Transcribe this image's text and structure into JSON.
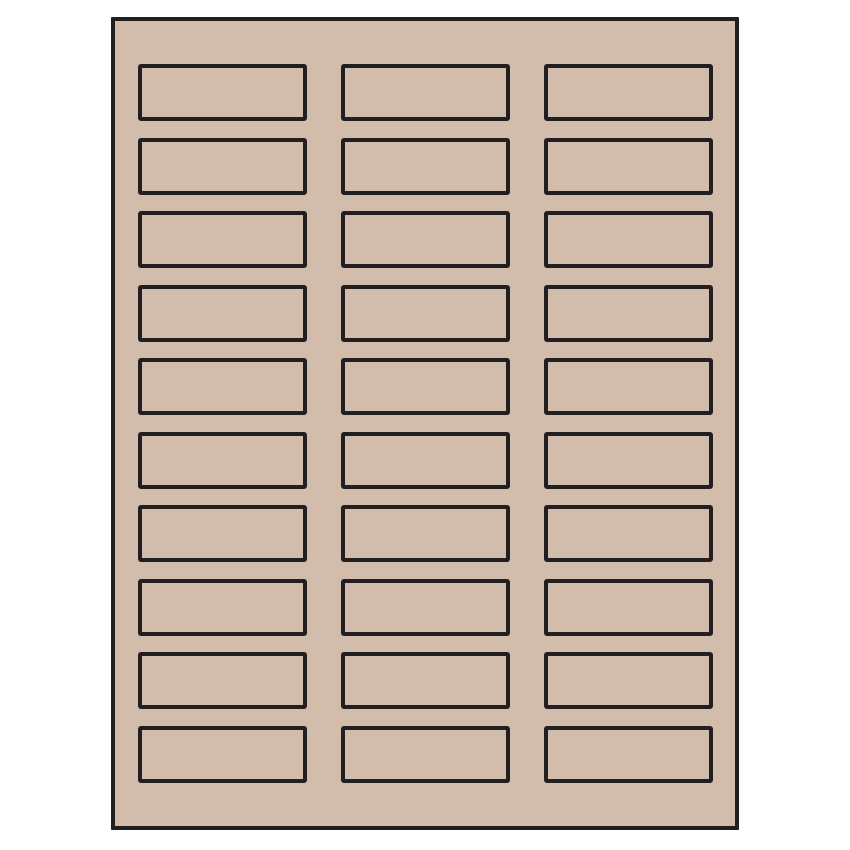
{
  "page": {
    "background_color": "#ffffff"
  },
  "sheet": {
    "description": "blank label sheet template",
    "background_color": "#d2bcab",
    "outline_color": "#231f20",
    "columns": 3,
    "rows": 10,
    "label_count": 30
  }
}
